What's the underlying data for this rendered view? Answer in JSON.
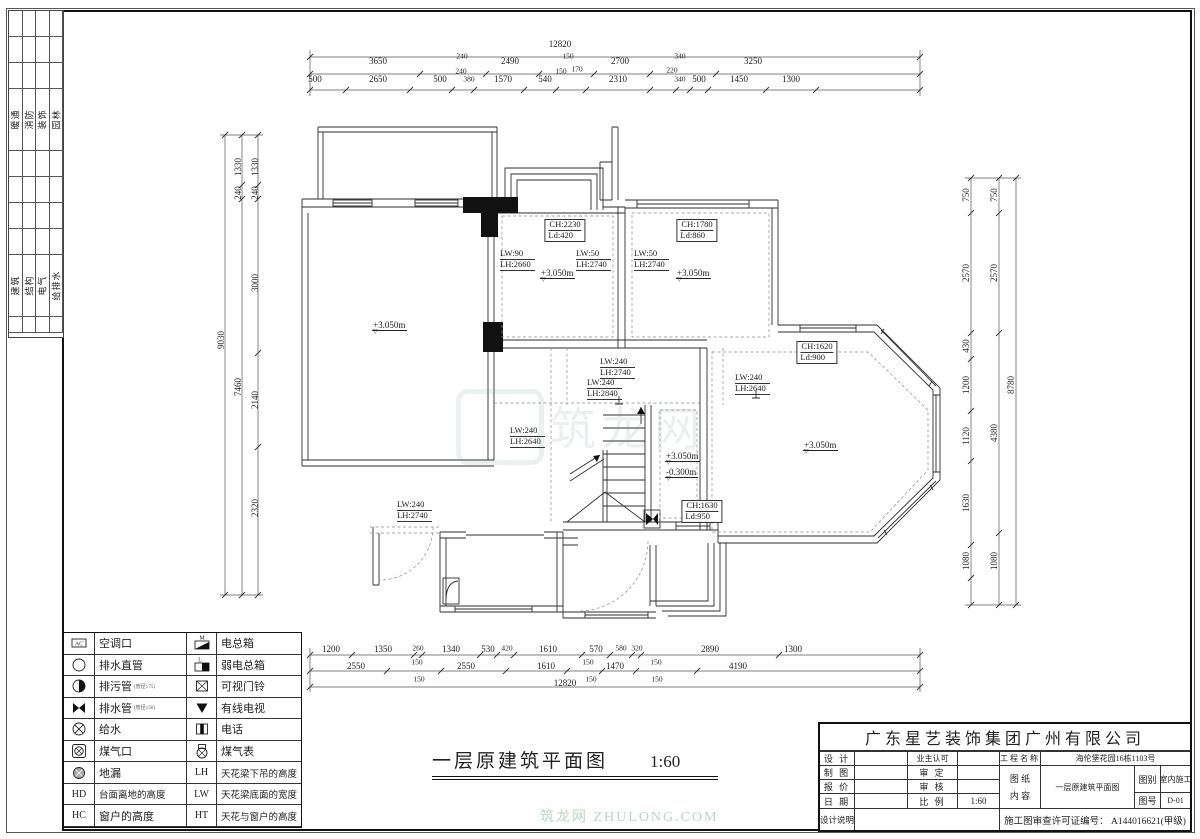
{
  "sheet": {
    "title": "一层原建筑平面图",
    "scale": "1:60"
  },
  "watermark": {
    "text": "筑龙网",
    "footer": "筑龙网 ZHULONG.COM"
  },
  "strip": {
    "group1": [
      "暖通",
      "消防",
      "装饰",
      "园林"
    ],
    "group2": [
      "建筑",
      "结构",
      "电气",
      "给排水"
    ]
  },
  "legend": {
    "rows": [
      {
        "i1": "ac",
        "l1": "空调口",
        "i2": "mbox",
        "l2": "电总箱"
      },
      {
        "i1": "circle",
        "l1": "排水直管",
        "i2": "lbox",
        "l2": "弱电总箱"
      },
      {
        "i1": "halfcircle",
        "l1": "排污管",
        "n1": "(管径≥75)",
        "i2": "doorbell",
        "l2": "可视门铃"
      },
      {
        "i1": "bowtie",
        "l1": "排水管",
        "n1": "(管径≥50)",
        "i2": "tv",
        "l2": "有线电视"
      },
      {
        "i1": "xcircle",
        "l1": "给水",
        "i2": "phone",
        "l2": "电话"
      },
      {
        "i1": "gasport",
        "l1": "煤气口",
        "i2": "gasmeter",
        "l2": "煤气表"
      },
      {
        "i1": "drain",
        "l1": "地漏",
        "k2": "LH",
        "l2": "天花梁下吊的高度"
      },
      {
        "k1": "HD",
        "l1": "台面离地的高度",
        "k2": "LW",
        "l2": "天花梁底面的宽度"
      },
      {
        "k1": "HC",
        "l1": "窗户的高度",
        "k2": "HT",
        "l2": "天花与窗户的高度"
      }
    ]
  },
  "title_block": {
    "company": "广东星艺装饰集团广州有限公司",
    "design": "设 计",
    "owner_ok": "业主认可",
    "project_label": "工程名称",
    "project": "海伦堡花园16栋1103号",
    "draft": "制 图",
    "approve": "审 定",
    "sheet_label": "图 纸",
    "content_label": "内 容",
    "content": "一层原建筑平面图",
    "type_label": "图别",
    "type_value": "室内施工",
    "quote": "报 价",
    "check": "审 核",
    "date": "日 期",
    "scale_label": "比 例",
    "scale_value": "1:60",
    "no_label": "图号",
    "no_value": "D-01",
    "notes": "设计说明",
    "license": "施工图审查许可证编号：  A144016621(甲级)"
  },
  "labels": [
    {
      "t": "12820",
      "x": 560,
      "y": 44,
      "c": "dim",
      "n": "dim-top-total"
    },
    {
      "t": "3650",
      "x": 378,
      "y": 61,
      "c": "dim"
    },
    {
      "t": "240",
      "x": 462,
      "y": 57,
      "c": "dims"
    },
    {
      "t": "2490",
      "x": 510,
      "y": 61,
      "c": "dim"
    },
    {
      "t": "150",
      "x": 568,
      "y": 57,
      "c": "dims"
    },
    {
      "t": "2700",
      "x": 620,
      "y": 61,
      "c": "dim"
    },
    {
      "t": "340",
      "x": 680,
      "y": 57,
      "c": "dims"
    },
    {
      "t": "3250",
      "x": 753,
      "y": 61,
      "c": "dim"
    },
    {
      "t": "500",
      "x": 315,
      "y": 79,
      "c": "dim"
    },
    {
      "t": "2650",
      "x": 378,
      "y": 79,
      "c": "dim"
    },
    {
      "t": "500",
      "x": 440,
      "y": 79,
      "c": "dim"
    },
    {
      "t": "240",
      "x": 461,
      "y": 72,
      "c": "dims"
    },
    {
      "t": "380",
      "x": 469,
      "y": 80,
      "c": "dims"
    },
    {
      "t": "1570",
      "x": 503,
      "y": 79,
      "c": "dim"
    },
    {
      "t": "540",
      "x": 545,
      "y": 79,
      "c": "dim"
    },
    {
      "t": "150",
      "x": 561,
      "y": 72,
      "c": "dims"
    },
    {
      "t": "170",
      "x": 577,
      "y": 70,
      "c": "dims"
    },
    {
      "t": "2310",
      "x": 618,
      "y": 79,
      "c": "dim"
    },
    {
      "t": "220",
      "x": 672,
      "y": 71,
      "c": "dims"
    },
    {
      "t": "340",
      "x": 680,
      "y": 80,
      "c": "dims"
    },
    {
      "t": "500",
      "x": 699,
      "y": 79,
      "c": "dim"
    },
    {
      "t": "1450",
      "x": 739,
      "y": 79,
      "c": "dim"
    },
    {
      "t": "1300",
      "x": 791,
      "y": 79,
      "c": "dim"
    },
    {
      "t": "1200",
      "x": 331,
      "y": 649,
      "c": "dim"
    },
    {
      "t": "1350",
      "x": 383,
      "y": 649,
      "c": "dim"
    },
    {
      "t": "260",
      "x": 418,
      "y": 649,
      "c": "dims"
    },
    {
      "t": "1340",
      "x": 451,
      "y": 649,
      "c": "dim"
    },
    {
      "t": "530",
      "x": 488,
      "y": 649,
      "c": "dim"
    },
    {
      "t": "420",
      "x": 507,
      "y": 649,
      "c": "dims"
    },
    {
      "t": "1610",
      "x": 548,
      "y": 649,
      "c": "dim"
    },
    {
      "t": "570",
      "x": 596,
      "y": 649,
      "c": "dim"
    },
    {
      "t": "580",
      "x": 621,
      "y": 649,
      "c": "dims"
    },
    {
      "t": "320",
      "x": 637,
      "y": 649,
      "c": "dims"
    },
    {
      "t": "2890",
      "x": 710,
      "y": 649,
      "c": "dim"
    },
    {
      "t": "1300",
      "x": 793,
      "y": 649,
      "c": "dim"
    },
    {
      "t": "2550",
      "x": 356,
      "y": 666,
      "c": "dim"
    },
    {
      "t": "150",
      "x": 417,
      "y": 663,
      "c": "dims"
    },
    {
      "t": "2550",
      "x": 466,
      "y": 666,
      "c": "dim"
    },
    {
      "t": "1610",
      "x": 546,
      "y": 666,
      "c": "dim"
    },
    {
      "t": "150",
      "x": 588,
      "y": 663,
      "c": "dims"
    },
    {
      "t": "1470",
      "x": 615,
      "y": 666,
      "c": "dim"
    },
    {
      "t": "150",
      "x": 656,
      "y": 663,
      "c": "dims"
    },
    {
      "t": "4190",
      "x": 738,
      "y": 666,
      "c": "dim"
    },
    {
      "t": "150",
      "x": 419,
      "y": 680,
      "c": "dims"
    },
    {
      "t": "12820",
      "x": 565,
      "y": 683,
      "c": "dim",
      "n": "dim-bottom-total"
    },
    {
      "t": "150",
      "x": 591,
      "y": 680,
      "c": "dims"
    },
    {
      "t": "150",
      "x": 657,
      "y": 680,
      "c": "dims"
    },
    {
      "t": "750",
      "x": 966,
      "y": 195,
      "c": "dimv"
    },
    {
      "t": "2570",
      "x": 966,
      "y": 273,
      "c": "dimv"
    },
    {
      "t": "430",
      "x": 966,
      "y": 346,
      "c": "dimv"
    },
    {
      "t": "1200",
      "x": 966,
      "y": 385,
      "c": "dimv"
    },
    {
      "t": "1120",
      "x": 966,
      "y": 436,
      "c": "dimv"
    },
    {
      "t": "1630",
      "x": 966,
      "y": 503,
      "c": "dimv"
    },
    {
      "t": "1080",
      "x": 966,
      "y": 561,
      "c": "dimv"
    },
    {
      "t": "750",
      "x": 994,
      "y": 195,
      "c": "dimv"
    },
    {
      "t": "2570",
      "x": 994,
      "y": 273,
      "c": "dimv"
    },
    {
      "t": "4380",
      "x": 994,
      "y": 433,
      "c": "dimv"
    },
    {
      "t": "1080",
      "x": 994,
      "y": 561,
      "c": "dimv"
    },
    {
      "t": "8780",
      "x": 1011,
      "y": 385,
      "c": "dimv",
      "n": "dim-right-total"
    },
    {
      "t": "9030",
      "x": 221,
      "y": 340,
      "c": "dimv",
      "n": "dim-left-total"
    },
    {
      "t": "1330",
      "x": 238,
      "y": 167,
      "c": "dimv"
    },
    {
      "t": "240",
      "x": 238,
      "y": 193,
      "c": "dimv"
    },
    {
      "t": "7460",
      "x": 238,
      "y": 387,
      "c": "dimv"
    },
    {
      "t": "1330",
      "x": 255,
      "y": 167,
      "c": "dimv"
    },
    {
      "t": "240",
      "x": 255,
      "y": 193,
      "c": "dimv"
    },
    {
      "t": "3000",
      "x": 255,
      "y": 283,
      "c": "dimv"
    },
    {
      "t": "2140",
      "x": 255,
      "y": 400,
      "c": "dimv"
    },
    {
      "t": "2320",
      "x": 255,
      "y": 508,
      "c": "dimv"
    },
    {
      "t": "CH:2230",
      "t2": "Ld:420",
      "x": 565,
      "y": 219,
      "c": "chbox",
      "n": "ceiling-height-label"
    },
    {
      "t": "CH:1780",
      "t2": "Ld:860",
      "x": 697,
      "y": 219,
      "c": "chbox",
      "n": "ceiling-height-label"
    },
    {
      "t": "CH:1620",
      "t2": "Ld:900",
      "x": 817,
      "y": 341,
      "c": "chbox",
      "n": "ceiling-height-label"
    },
    {
      "t": "CH:1630",
      "t2": "Ld:950",
      "x": 702,
      "y": 500,
      "c": "chbox",
      "n": "ceiling-height-label"
    },
    {
      "t": "LW:90",
      "t2": "LH:2660",
      "x": 500,
      "y": 249,
      "c": "lw",
      "n": "beam-label"
    },
    {
      "t": "LW:50",
      "t2": "LH:2740",
      "x": 576,
      "y": 249,
      "c": "lw",
      "n": "beam-label"
    },
    {
      "t": "LW:50",
      "t2": "LH:2740",
      "x": 634,
      "y": 249,
      "c": "lw",
      "n": "beam-label"
    },
    {
      "t": "LW:240",
      "t2": "LH:2740",
      "x": 600,
      "y": 357,
      "c": "lw",
      "n": "beam-label"
    },
    {
      "t": "LW:240",
      "t2": "LH:2840",
      "x": 587,
      "y": 378,
      "c": "lw",
      "n": "beam-label"
    },
    {
      "t": "LW:240",
      "t2": "LH:2640",
      "x": 735,
      "y": 373,
      "c": "lw",
      "n": "beam-label"
    },
    {
      "t": "LW:240",
      "t2": "LH:2640",
      "x": 510,
      "y": 426,
      "c": "lw",
      "n": "beam-label"
    },
    {
      "t": "LW:240",
      "t2": "LH:2740",
      "x": 397,
      "y": 500,
      "c": "lw",
      "n": "beam-label"
    },
    {
      "t": "+3.050m",
      "x": 540,
      "y": 268,
      "c": "lvl",
      "n": "level-label"
    },
    {
      "t": "+3.050m",
      "x": 676,
      "y": 268,
      "c": "lvl",
      "n": "level-label"
    },
    {
      "t": "+3.050m",
      "x": 372,
      "y": 320,
      "c": "lvl",
      "n": "level-label"
    },
    {
      "t": "+3.050m",
      "x": 803,
      "y": 440,
      "c": "lvl",
      "n": "level-label"
    },
    {
      "t": "+3.050m",
      "x": 665,
      "y": 451,
      "c": "lvl",
      "n": "level-label"
    },
    {
      "t": "-0.300m",
      "x": 665,
      "y": 467,
      "c": "lvl",
      "n": "level-label"
    }
  ]
}
